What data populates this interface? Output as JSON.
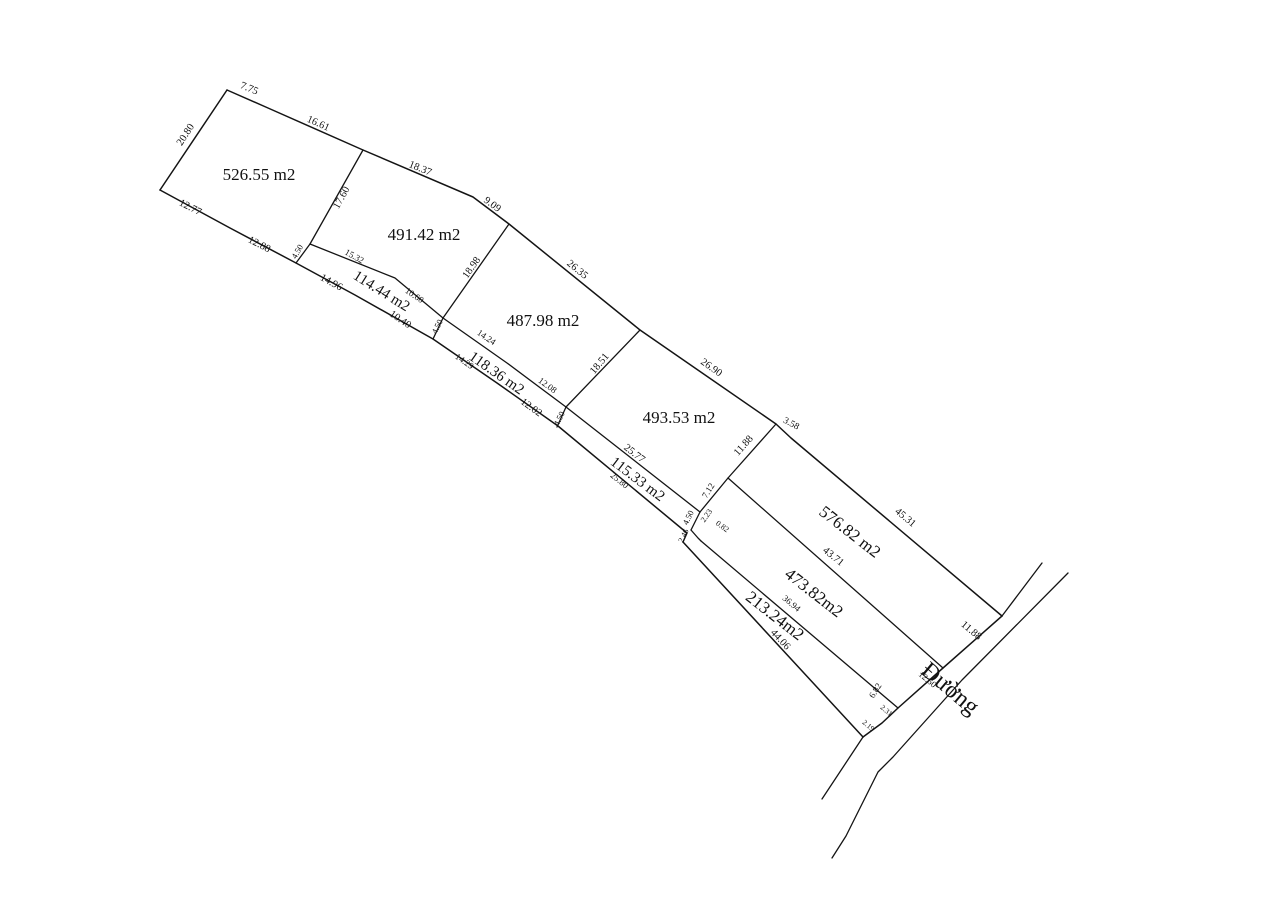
{
  "diagram": {
    "type": "cadastral-survey-plan",
    "background_color": "#ffffff",
    "line_color": "#141414",
    "road_label": {
      "text": "Đường",
      "x": 949,
      "y": 690,
      "rot": 40,
      "size": 24
    },
    "parcel_labels": [
      {
        "text": "526.55 m2",
        "x": 259,
        "y": 176,
        "rot": 0,
        "size": 17
      },
      {
        "text": "491.42 m2",
        "x": 424,
        "y": 236,
        "rot": 0,
        "size": 17
      },
      {
        "text": "487.98 m2",
        "x": 543,
        "y": 322,
        "rot": 0,
        "size": 17
      },
      {
        "text": "493.53 m2",
        "x": 679,
        "y": 419,
        "rot": 0,
        "size": 17
      },
      {
        "text": "576.82 m2",
        "x": 849,
        "y": 533,
        "rot": 38,
        "size": 17
      },
      {
        "text": "473.82m2",
        "x": 813,
        "y": 594,
        "rot": 38,
        "size": 17
      },
      {
        "text": "213.24m2",
        "x": 774,
        "y": 617,
        "rot": 38,
        "size": 17
      },
      {
        "text": "114.44 m2",
        "x": 381,
        "y": 292,
        "rot": 32,
        "size": 15
      },
      {
        "text": "118.36 m2",
        "x": 496,
        "y": 374,
        "rot": 35,
        "size": 15
      },
      {
        "text": "115.33 m2",
        "x": 637,
        "y": 480,
        "rot": 37,
        "size": 15
      }
    ],
    "measurement_labels": [
      {
        "text": "7.75",
        "x": 249,
        "y": 89,
        "rot": 22,
        "size": 10.5
      },
      {
        "text": "16.61",
        "x": 318,
        "y": 124,
        "rot": 24,
        "size": 10.5
      },
      {
        "text": "18.37",
        "x": 420,
        "y": 169,
        "rot": 22,
        "size": 10.5
      },
      {
        "text": "9.09",
        "x": 492,
        "y": 205,
        "rot": 36,
        "size": 10.5
      },
      {
        "text": "26.35",
        "x": 577,
        "y": 270,
        "rot": 39,
        "size": 10.5
      },
      {
        "text": "26.90",
        "x": 711,
        "y": 368,
        "rot": 35,
        "size": 10.5
      },
      {
        "text": "3.58",
        "x": 791,
        "y": 424,
        "rot": 28,
        "size": 9.5
      },
      {
        "text": "45.31",
        "x": 905,
        "y": 518,
        "rot": 40,
        "size": 10.5
      },
      {
        "text": "20.80",
        "x": 186,
        "y": 135,
        "rot": -57,
        "size": 10.5
      },
      {
        "text": "12.77",
        "x": 190,
        "y": 208,
        "rot": 27,
        "size": 10.5
      },
      {
        "text": "12.88",
        "x": 259,
        "y": 245,
        "rot": 27,
        "size": 10.5
      },
      {
        "text": "17.60",
        "x": 342,
        "y": 198,
        "rot": -61,
        "size": 10.5
      },
      {
        "text": "4.50",
        "x": 298,
        "y": 252,
        "rot": -60,
        "size": 8.5
      },
      {
        "text": "15.32",
        "x": 354,
        "y": 257,
        "rot": 29,
        "size": 9
      },
      {
        "text": "10.60",
        "x": 414,
        "y": 296,
        "rot": 34,
        "size": 9
      },
      {
        "text": "14.96",
        "x": 331,
        "y": 283,
        "rot": 29,
        "size": 10.5
      },
      {
        "text": "10.40",
        "x": 400,
        "y": 320,
        "rot": 34,
        "size": 10.5
      },
      {
        "text": "18.98",
        "x": 472,
        "y": 268,
        "rot": -55,
        "size": 10.5
      },
      {
        "text": "4.50",
        "x": 438,
        "y": 327,
        "rot": -64,
        "size": 8.5
      },
      {
        "text": "14.24",
        "x": 486,
        "y": 338,
        "rot": 34,
        "size": 9
      },
      {
        "text": "12.08",
        "x": 547,
        "y": 386,
        "rot": 36,
        "size": 9
      },
      {
        "text": "14.29",
        "x": 464,
        "y": 362,
        "rot": 35,
        "size": 9
      },
      {
        "text": "12.02",
        "x": 531,
        "y": 408,
        "rot": 36,
        "size": 10.5
      },
      {
        "text": "18.51",
        "x": 600,
        "y": 364,
        "rot": -50,
        "size": 10.5
      },
      {
        "text": "4.50",
        "x": 560,
        "y": 419,
        "rot": -64,
        "size": 8.5
      },
      {
        "text": "25.77",
        "x": 634,
        "y": 454,
        "rot": 38,
        "size": 10.5
      },
      {
        "text": "25.80",
        "x": 619,
        "y": 481,
        "rot": 38,
        "size": 9
      },
      {
        "text": "11.88",
        "x": 744,
        "y": 446,
        "rot": -48,
        "size": 10.5
      },
      {
        "text": "7.12",
        "x": 709,
        "y": 491,
        "rot": -58,
        "size": 9
      },
      {
        "text": "4.50",
        "x": 689,
        "y": 518,
        "rot": -64,
        "size": 8.5
      },
      {
        "text": "2.23",
        "x": 707,
        "y": 516,
        "rot": -55,
        "size": 8
      },
      {
        "text": "0.82",
        "x": 722,
        "y": 527,
        "rot": 36,
        "size": 8
      },
      {
        "text": "2.46",
        "x": 684,
        "y": 536,
        "rot": -64,
        "size": 8
      },
      {
        "text": "43.71",
        "x": 833,
        "y": 557,
        "rot": 39,
        "size": 10.5
      },
      {
        "text": "36.94",
        "x": 791,
        "y": 604,
        "rot": 40,
        "size": 9
      },
      {
        "text": "44.06",
        "x": 780,
        "y": 640,
        "rot": 47,
        "size": 10.5
      },
      {
        "text": "11.88",
        "x": 971,
        "y": 631,
        "rot": 40,
        "size": 10.5
      },
      {
        "text": "12.60",
        "x": 927,
        "y": 680,
        "rot": 40,
        "size": 9
      },
      {
        "text": "6.82",
        "x": 876,
        "y": 691,
        "rot": -58,
        "size": 9
      },
      {
        "text": "2.31",
        "x": 886,
        "y": 711,
        "rot": 40,
        "size": 7.5
      },
      {
        "text": "2.19",
        "x": 868,
        "y": 726,
        "rot": 40,
        "size": 7.5
      }
    ]
  }
}
